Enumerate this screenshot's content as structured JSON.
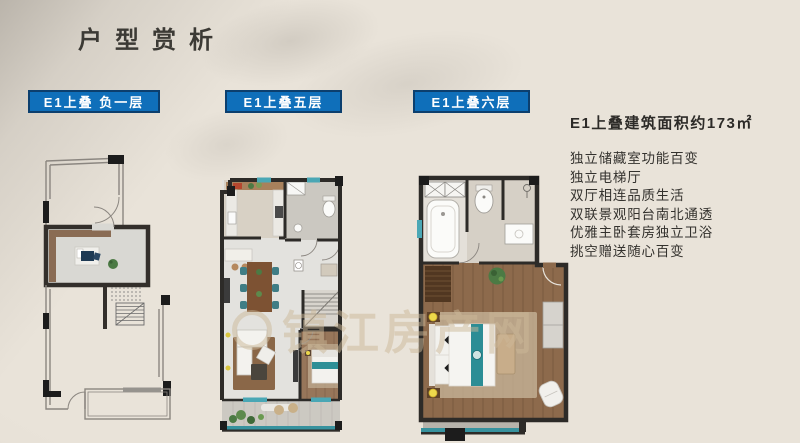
{
  "page": {
    "title": "户型赏析"
  },
  "plans": [
    {
      "label": "E1上叠 负一层"
    },
    {
      "label": "E1上叠五层"
    },
    {
      "label": "E1上叠六层"
    }
  ],
  "info": {
    "area_title": "E1上叠建筑面积约173㎡",
    "features": [
      "独立储藏室功能百变",
      "独立电梯厅",
      "双厅相连品质生活",
      "双联景观阳台南北通透",
      "优雅主卧套房独立卫浴",
      "挑空赠送随心百变"
    ]
  },
  "watermark": {
    "text": "镇江房产网"
  },
  "colors": {
    "background": "#e9e3d9",
    "accent_blue": "#0f6fba",
    "label_border": "#0c3f6e",
    "wall_dark": "#2d2b28",
    "wood_floor": "#8d6a4c",
    "teal": "#2e8f96",
    "window_teal": "#4aa7b5",
    "watermark": "rgba(204,184,152,0.5)"
  }
}
